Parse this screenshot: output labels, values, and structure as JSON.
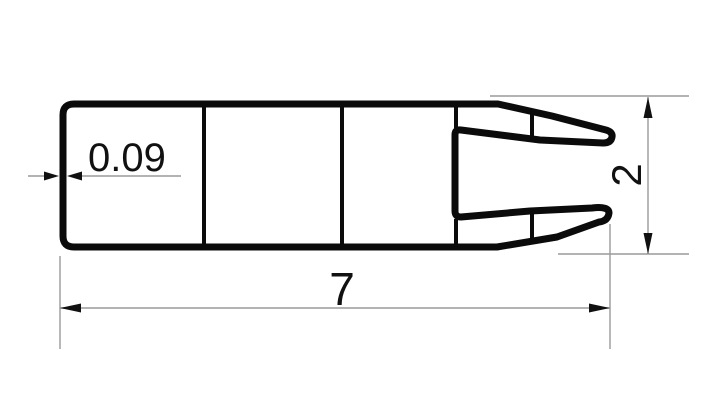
{
  "drawing": {
    "kind": "technical profile drawing with dimensions",
    "dimensions": {
      "wall_thickness": {
        "label": "0.09"
      },
      "overall_length": {
        "label": "7"
      },
      "overall_height": {
        "label": "2"
      }
    },
    "colors": {
      "outline": "#0b0b0b",
      "hairline": "#9a9a9a",
      "text": "#111111",
      "background": "#ffffff"
    }
  }
}
